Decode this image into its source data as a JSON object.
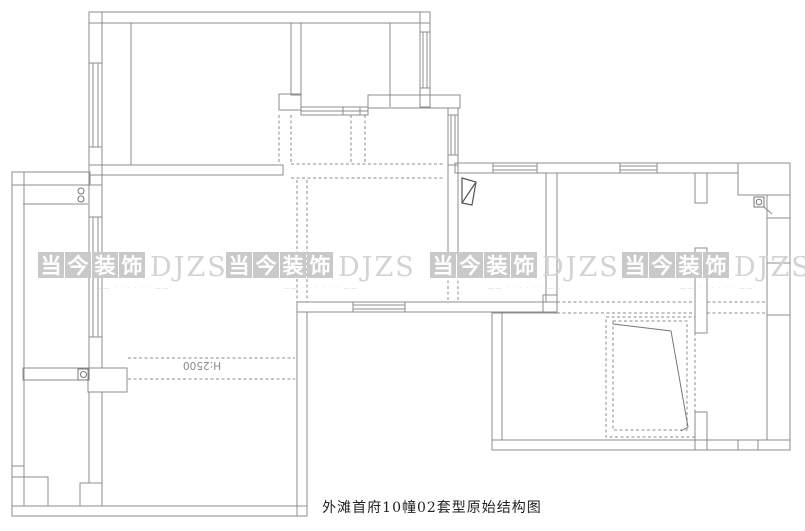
{
  "caption": "外滩首府10幢02套型原始结构图",
  "labels": {
    "beam_height": "H:2500"
  },
  "watermark": {
    "chars": [
      "当",
      "今",
      "装",
      "饰"
    ],
    "latin": "DJZS",
    "tagline": "——  · · ·  · · ·  ——",
    "tile_color": "#c9c9c9",
    "char_color": "#ffffff",
    "latin_color": "#d3d3d3",
    "tagline_color": "#d0d0d0",
    "instances": 4
  },
  "plan": {
    "background": "#ffffff",
    "wall_color": "#8c8c8c",
    "symbol_color": "#555555",
    "symbols": [
      "flue",
      "stove-burners",
      "floor-drain",
      "wall-drain"
    ]
  }
}
